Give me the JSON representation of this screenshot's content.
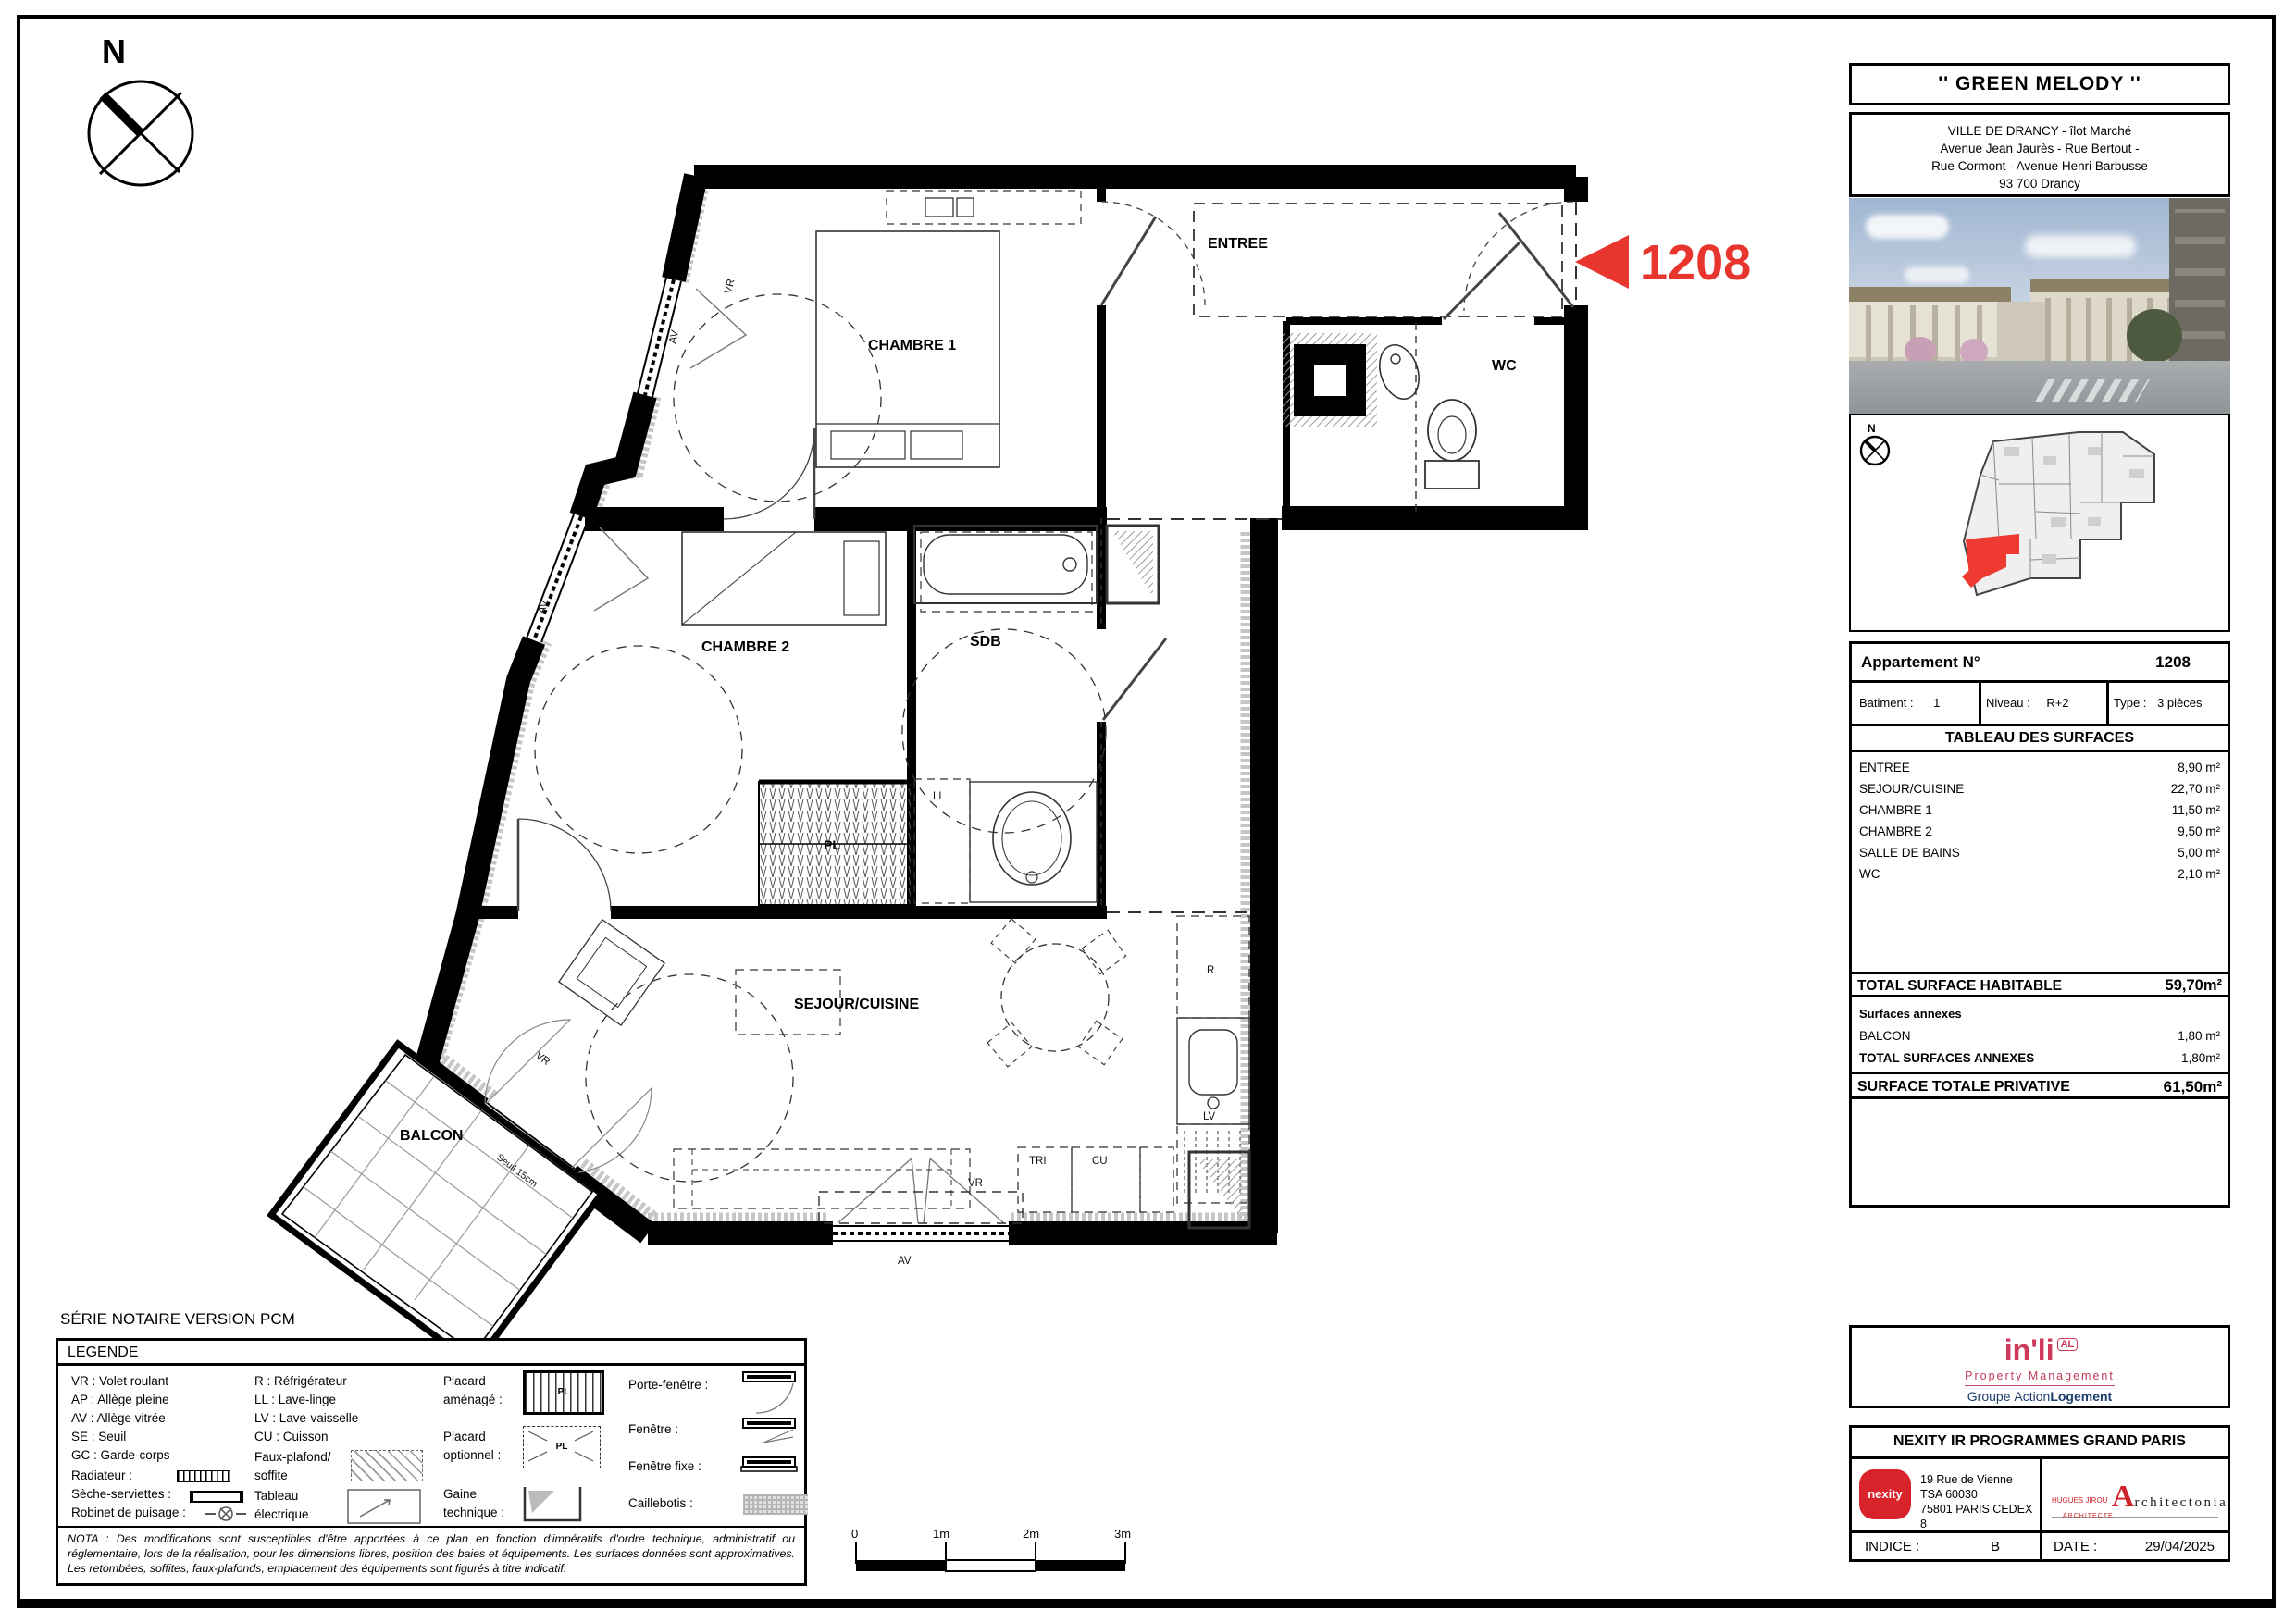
{
  "plan": {
    "north": "N",
    "series_label": "SÉRIE NOTAIRE VERSION PCM",
    "callout_number": "1208",
    "accent_color": "#e8352e",
    "rooms": {
      "entree": "ENTREE",
      "chambre1": "CHAMBRE 1",
      "chambre2": "CHAMBRE 2",
      "sdb": "SDB",
      "wc": "WC",
      "sejour": "SEJOUR/CUISINE",
      "balcon": "BALCON",
      "pl": "PL"
    },
    "tags": {
      "av": "AV",
      "vr": "VR",
      "ll": "LL",
      "lv": "LV",
      "r": "R",
      "tri": "TRI",
      "cu": "CU",
      "seuil": "Seuil 15cm"
    },
    "scale": {
      "s0": "0",
      "s1": "1m",
      "s2": "2m",
      "s3": "3m"
    }
  },
  "legend": {
    "title": "LEGENDE",
    "col1": [
      "VR : Volet roulant",
      "AP : Allège pleine",
      "AV : Allège vitrée",
      "SE : Seuil",
      "GC : Garde-corps"
    ],
    "sym1": [
      "Radiateur :",
      "Sèche-serviettes :",
      "Robinet de puisage :"
    ],
    "col2": [
      "R : Réfrigérateur",
      "LL : Lave-linge",
      "LV : Lave-vaisselle",
      "CU : Cuisson"
    ],
    "fp1": "Faux-plafond/",
    "fp2": "soffite",
    "te1": "Tableau",
    "te2": "électrique",
    "p1a": "Placard",
    "p1b": "aménagé :",
    "p2a": "Placard",
    "p2b": "optionnel :",
    "g1": "Gaine",
    "g2": "technique :",
    "col4": [
      "Porte-fenêtre :",
      "Fenêtre :",
      "Fenêtre fixe :",
      "Caillebotis :"
    ],
    "pl": "PL",
    "nota": "NOTA : Des modifications sont susceptibles d'être apportées à ce plan en fonction d'impératifs d'ordre technique, administratif ou réglementaire, lors de la réalisation, pour les dimensions libres, position des baies et équipements. Les surfaces données sont approximatives. Les retombées, soffites, faux-plafonds, emplacement des équipements sont figurés à titre indicatif."
  },
  "panel": {
    "title": "'' GREEN MELODY ''",
    "addr": [
      "VILLE DE DRANCY - îlot Marché",
      "Avenue Jean Jaurès - Rue Bertout -",
      "Rue Cormont - Avenue Henri Barbusse",
      "93 700 Drancy"
    ],
    "apt_label": "Appartement N°",
    "apt_no": "1208",
    "bat_label": "Batiment :",
    "bat_val": "1",
    "niv_label": "Niveau :",
    "niv_val": "R+2",
    "type_label": "Type :",
    "type_val": "3 pièces",
    "surf_title": "TABLEAU DES SURFACES",
    "surfaces": [
      {
        "label": "ENTREE",
        "value": "8,90 m²"
      },
      {
        "label": "SEJOUR/CUISINE",
        "value": "22,70 m²"
      },
      {
        "label": "CHAMBRE 1",
        "value": "11,50 m²"
      },
      {
        "label": "CHAMBRE 2",
        "value": "9,50 m²"
      },
      {
        "label": "SALLE DE BAINS",
        "value": "5,00 m²"
      },
      {
        "label": "WC",
        "value": "2,10 m²"
      }
    ],
    "total_label": "TOTAL SURFACE HABITABLE",
    "total_value": "59,70m²",
    "annex_title": "Surfaces annexes",
    "annex_rows": [
      {
        "label": "BALCON",
        "value": "1,80 m²"
      }
    ],
    "total_annex_label": "TOTAL SURFACES ANNEXES",
    "total_annex_value": "1,80m²",
    "priv_label": "SURFACE TOTALE PRIVATIVE",
    "priv_value": "61,50m²",
    "inli": {
      "word": "in'li",
      "badge": "AL",
      "tagline": "Property Management",
      "g1": "Groupe",
      "g2": "Action",
      "g3": "Logement",
      "brand_color": "#cf3a5c",
      "group_color": "#1d3d6e"
    },
    "nexity_title": "NEXITY IR PROGRAMMES GRAND PARIS",
    "nexity_logo": "nexity",
    "nexity_logo_color": "#d8232a",
    "nexity_addr": [
      "19 Rue de Vienne",
      "TSA 60030",
      "75801 PARIS CEDEX 8"
    ],
    "arch": {
      "a": "A",
      "rest": "rchitectonia",
      "sub1": "HUGUES JIROU",
      "sub2": "ARCHITECTE"
    },
    "indice_label": "INDICE :",
    "indice_value": "B",
    "date_label": "DATE :",
    "date_value": "29/04/2025"
  }
}
